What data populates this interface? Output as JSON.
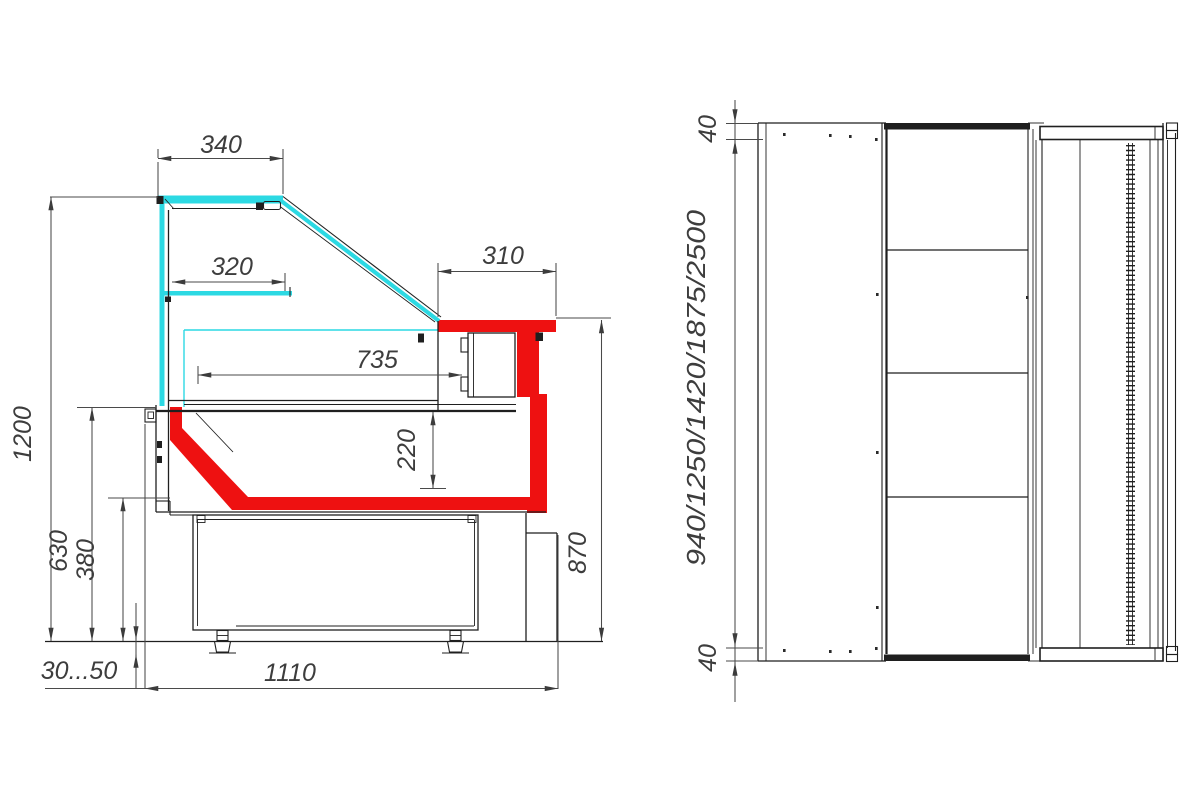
{
  "colors": {
    "ink": "#1f1f1f",
    "dim": "#4a4a4a",
    "txt": "#3d3d3d",
    "cyan": "#2cd9e3",
    "red": "#ee1111"
  },
  "views": {
    "side": {
      "label": "side-section-view",
      "dims": {
        "canopy_depth": "340",
        "shelf_depth": "320",
        "rear_top_depth": "310",
        "well_depth": "735",
        "well_height": "220",
        "overall_height": "1200",
        "front_height": "630",
        "base_height": "380",
        "rear_height": "870",
        "feet_range": "30...50",
        "base_depth": "1110"
      }
    },
    "top": {
      "label": "top-view",
      "dims": {
        "end_margin_top": "40",
        "length_options": "940/1250/1420/1875/2500",
        "end_margin_bottom": "40"
      }
    }
  }
}
